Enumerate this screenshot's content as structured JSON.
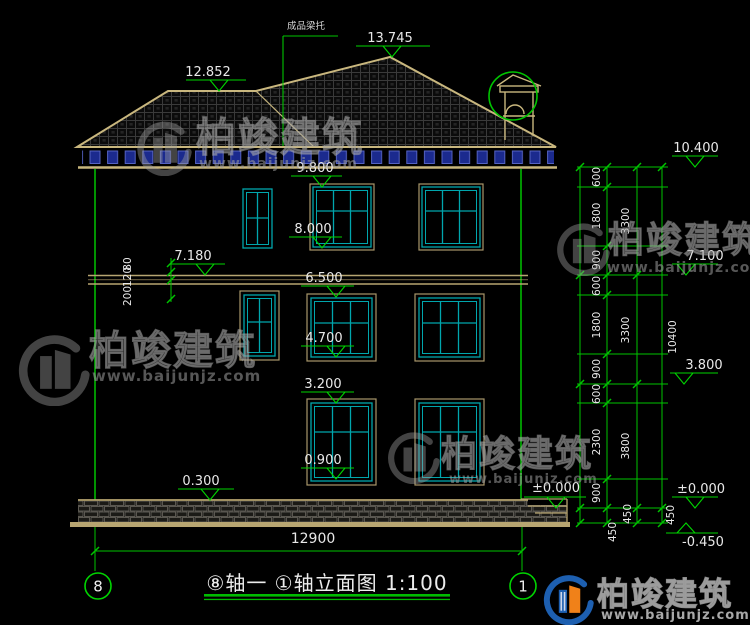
{
  "watermark": {
    "brand": "柏竣建筑",
    "url": "www.baijunjz.com"
  },
  "title_block": {
    "title": "⑧轴一 ①轴立面图 1:100",
    "axis_left": "8",
    "axis_right": "1"
  },
  "annotations": {
    "roof_note": "成品梁托"
  },
  "elevations": {
    "roof_peak": "13.745",
    "roof_left": "12.852",
    "f3_head": "9.800",
    "f3_sill": "8.000",
    "band_top": "7.180",
    "f2_head": "6.500",
    "f2_sill": "4.700",
    "f1_head": "3.200",
    "f1_sill": "0.900",
    "plinth": "0.300",
    "ground_right": "±0.000"
  },
  "left_dims": [
    "80",
    "120",
    "200"
  ],
  "right_dims": {
    "chain_inner": [
      "600",
      "1800",
      "900",
      "600",
      "1800",
      "900",
      "600",
      "2300",
      "900",
      "450"
    ],
    "chain_mid": [
      "3300",
      "3300",
      "3800",
      "450"
    ],
    "chain_outer": [
      "10400",
      "450"
    ],
    "levels": [
      "10.400",
      "7.100",
      "3.800",
      "±0.000",
      "-0.450"
    ]
  },
  "bottom_dim": "12900"
}
